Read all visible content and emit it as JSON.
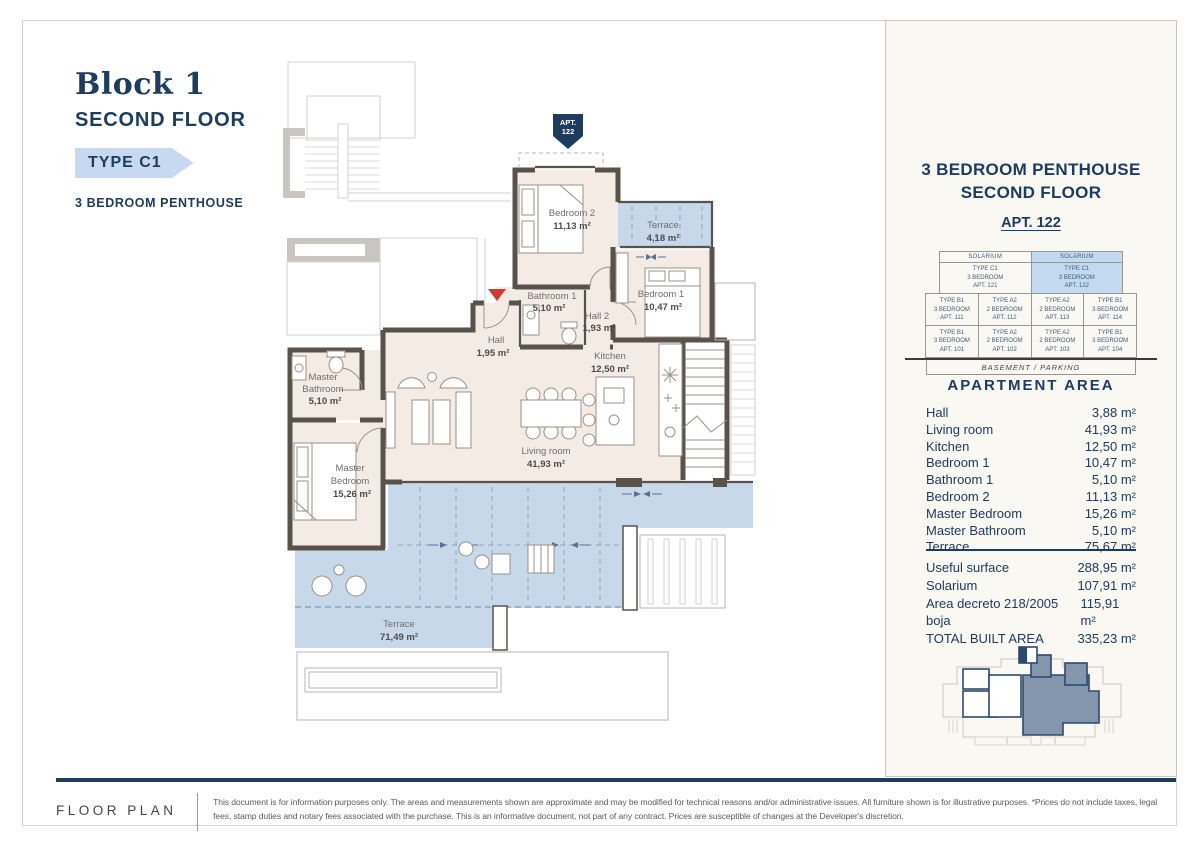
{
  "colors": {
    "navy": "#1d3c60",
    "tagblue": "#c6d9f0",
    "hlblue": "#c3d9f0",
    "wall": "#59524b",
    "beige": "#f4ebe5",
    "tblue": "#c7d8eb",
    "red": "#cf3b30"
  },
  "header": {
    "block": "Block 1",
    "floor": "SECOND FLOOR",
    "type_tag": "TYPE C1",
    "subtitle": "3 BEDROOM PENTHOUSE"
  },
  "plan": {
    "apt_badge": {
      "line1": "APT.",
      "line2": "122"
    },
    "rooms": {
      "bedroom2": {
        "name": "Bedroom 2",
        "area": "11,13 m²"
      },
      "terrace_top": {
        "name": "Terrace",
        "area": "4,18 m²"
      },
      "bedroom1": {
        "name": "Bedroom 1",
        "area": "10,47 m²"
      },
      "bathroom1": {
        "name": "Bathroom 1",
        "area": "5,10 m²"
      },
      "hall2": {
        "name": "Hall 2",
        "area": "1,93 m²"
      },
      "hall": {
        "name": "Hall",
        "area": "1,95 m²"
      },
      "kitchen": {
        "name": "Kitchen",
        "area": "12,50 m²"
      },
      "master_bathroom": {
        "name": "Master",
        "name2": "Bathroom",
        "area": "5,10 m²"
      },
      "master_bedroom": {
        "name": "Master",
        "name2": "Bedroom",
        "area": "15,26 m²"
      },
      "living": {
        "name": "Living room",
        "area": "41,93 m²"
      },
      "terrace_main": {
        "name": "Terrace",
        "area": "71,49 m²"
      }
    }
  },
  "panel": {
    "title_line1": "3 BEDROOM PENTHOUSE",
    "title_line2": "SECOND FLOOR",
    "apt": "APT. 122",
    "building": {
      "sol_left": "SOLARIUM",
      "sol_right": "SOLARIUM",
      "pent_left": [
        "TYPE C1",
        "3 BEDROOM",
        "APT. 121"
      ],
      "pent_right": [
        "TYPE C1",
        "3 BEDROOM",
        "APT. 122"
      ],
      "row1": [
        [
          "TYPE B1",
          "3 BEDROOM",
          "APT. 111"
        ],
        [
          "TYPE A2",
          "2 BEDROOM",
          "APT. 112"
        ],
        [
          "TYPE A2",
          "2 BEDROOM",
          "APT. 113"
        ],
        [
          "TYPE B1",
          "3 BEDROOM",
          "APT. 114"
        ]
      ],
      "row2": [
        [
          "TYPE B1",
          "3 BEDROOM",
          "APT. 101"
        ],
        [
          "TYPE A2",
          "2 BEDROOM",
          "APT. 102"
        ],
        [
          "TYPE A2",
          "2 BEDROOM",
          "APT. 103"
        ],
        [
          "TYPE B1",
          "3 BEDROOM",
          "APT. 104"
        ]
      ],
      "basement": "BASEMENT / PARKING"
    },
    "area_title": "APARTMENT AREA",
    "areas": [
      {
        "label": "Hall",
        "value": "3,88 m²"
      },
      {
        "label": "Living room",
        "value": "41,93 m²"
      },
      {
        "label": "Kitchen",
        "value": "12,50 m²"
      },
      {
        "label": "Bedroom 1",
        "value": "10,47 m²"
      },
      {
        "label": "Bathroom 1",
        "value": "5,10 m²"
      },
      {
        "label": "Bedroom 2",
        "value": "11,13 m²"
      },
      {
        "label": "Master Bedroom",
        "value": "15,26 m²"
      },
      {
        "label": "Master Bathroom",
        "value": "5,10 m²"
      },
      {
        "label": "Terrace",
        "value": "75,67 m²"
      }
    ],
    "totals": [
      {
        "label": "Useful surface",
        "value": "288,95 m²"
      },
      {
        "label": "Solarium",
        "value": "107,91 m²"
      },
      {
        "label": "Area decreto 218/2005 boja",
        "value": "115,91 m²"
      },
      {
        "label": "TOTAL BUILT AREA",
        "value": "335,23 m²"
      }
    ]
  },
  "footer": {
    "label": "FLOOR PLAN",
    "disclaimer": "This document is for information purposes only. The areas and measurements shown are approximate and may be modified for technical reasons and/or administrative issues. All furniture shown is for illustrative purposes. *Prices do not include taxes, legal fees, stamp duties and notary fees associated with the purchase. This is an informative document, not part of any contract. Prices are susceptible of changes at the Developer's discretion."
  }
}
